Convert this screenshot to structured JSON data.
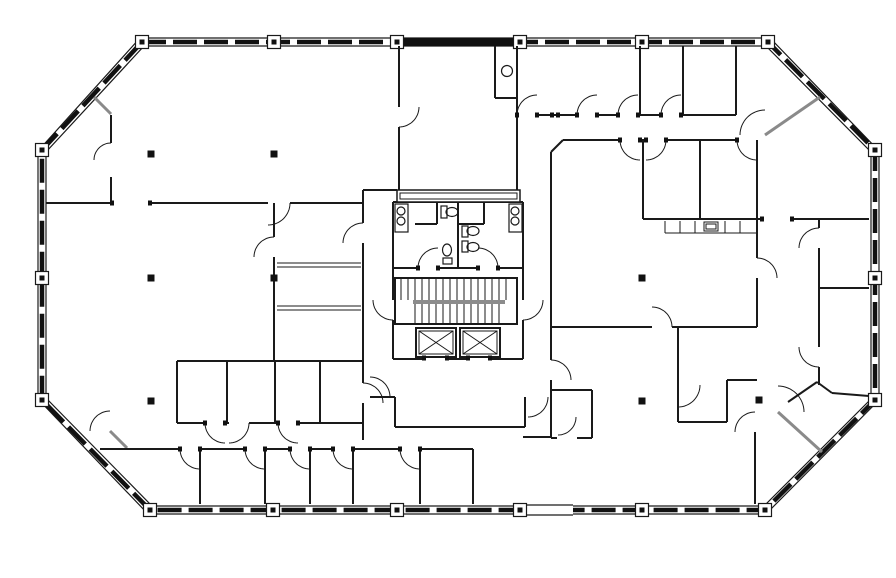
{
  "drawing": {
    "kind": "architectural-floor-plan",
    "background": "#ffffff",
    "wall_color": "#1a1a1a",
    "glazing_color": "#111111",
    "partition_gray": "#8a8a8a",
    "column_fill": "#111111"
  },
  "summary": {
    "elevators": 2,
    "stair_flights": 2,
    "restrooms": 2,
    "toilets": 4,
    "lavatory_sinks": 4,
    "counter_sinks": 2,
    "interior_columns": 8,
    "perimeter_columns": 18,
    "door_swings": 38
  },
  "floor_plan": {
    "canvas": {
      "w": 896,
      "h": 578
    },
    "shell": {
      "outer": [
        [
          140,
          38
        ],
        [
          770,
          38
        ],
        [
          879,
          151
        ],
        [
          879,
          400
        ],
        [
          766,
          514
        ],
        [
          148,
          514
        ],
        [
          38,
          399
        ],
        [
          38,
          151
        ]
      ],
      "inner": [
        [
          144,
          46
        ],
        [
          766,
          46
        ],
        [
          871,
          152
        ],
        [
          871,
          399
        ],
        [
          764,
          506
        ],
        [
          152,
          506
        ],
        [
          46,
          398
        ],
        [
          46,
          152
        ]
      ],
      "center": [
        [
          142,
          42
        ],
        [
          768,
          42
        ],
        [
          875,
          150
        ],
        [
          875,
          400
        ],
        [
          765,
          510
        ],
        [
          150,
          510
        ],
        [
          42,
          400
        ],
        [
          42,
          150
        ]
      ],
      "solid_band_rect": [
        399,
        38,
        118,
        8
      ],
      "band_gap_rect": [
        523,
        504,
        50,
        12
      ],
      "mullion_columns": [
        [
          142,
          42
        ],
        [
          274,
          42
        ],
        [
          397,
          42
        ],
        [
          520,
          42
        ],
        [
          642,
          42
        ],
        [
          768,
          42
        ],
        [
          875,
          150
        ],
        [
          875,
          278
        ],
        [
          875,
          400
        ],
        [
          765,
          510
        ],
        [
          642,
          510
        ],
        [
          520,
          510
        ],
        [
          397,
          510
        ],
        [
          273,
          510
        ],
        [
          150,
          510
        ],
        [
          42,
          400
        ],
        [
          42,
          278
        ],
        [
          42,
          150
        ]
      ]
    },
    "walls": [
      [
        46,
        203,
        111,
        203
      ],
      [
        150,
        203,
        268,
        203
      ],
      [
        290,
        203,
        363,
        203
      ],
      [
        111,
        115,
        111,
        143
      ],
      [
        111,
        177,
        111,
        203
      ],
      [
        363,
        190,
        363,
        223
      ],
      [
        363,
        243,
        363,
        383
      ],
      [
        363,
        403,
        363,
        440
      ],
      [
        363,
        190,
        397,
        190
      ],
      [
        274,
        203,
        274,
        237
      ],
      [
        274,
        257,
        274,
        361
      ],
      [
        177,
        361,
        177,
        423
      ],
      [
        177,
        361,
        363,
        361
      ],
      [
        227,
        361,
        227,
        423
      ],
      [
        275,
        361,
        275,
        423
      ],
      [
        320,
        361,
        320,
        423
      ],
      [
        177,
        423,
        205,
        423
      ],
      [
        225,
        423,
        229,
        423
      ],
      [
        249,
        423,
        278,
        423
      ],
      [
        298,
        423,
        363,
        423
      ],
      [
        100,
        449,
        180,
        449
      ],
      [
        200,
        449,
        245,
        449
      ],
      [
        265,
        449,
        290,
        449
      ],
      [
        310,
        449,
        333,
        449
      ],
      [
        353,
        449,
        400,
        449
      ],
      [
        420,
        449,
        473,
        449
      ],
      [
        200,
        449,
        200,
        504
      ],
      [
        265,
        449,
        265,
        504
      ],
      [
        310,
        449,
        310,
        504
      ],
      [
        353,
        449,
        353,
        504
      ],
      [
        420,
        449,
        420,
        504
      ],
      [
        473,
        449,
        473,
        504
      ],
      [
        399,
        46,
        399,
        107
      ],
      [
        399,
        127,
        399,
        190
      ],
      [
        517,
        46,
        517,
        190
      ],
      [
        495,
        46,
        495,
        98
      ],
      [
        495,
        98,
        517,
        98
      ],
      [
        537,
        115,
        577,
        115
      ],
      [
        597,
        115,
        618,
        115
      ],
      [
        638,
        115,
        661,
        115
      ],
      [
        681,
        115,
        736,
        115
      ],
      [
        640,
        46,
        640,
        115
      ],
      [
        683,
        46,
        683,
        115
      ],
      [
        736,
        46,
        736,
        115
      ],
      [
        563,
        140,
        620,
        140
      ],
      [
        640,
        140,
        646,
        140
      ],
      [
        666,
        140,
        737,
        140
      ],
      [
        551,
        152,
        563,
        140
      ],
      [
        551,
        152,
        551,
        360
      ],
      [
        551,
        380,
        551,
        437
      ],
      [
        643,
        140,
        643,
        219
      ],
      [
        700,
        140,
        700,
        219
      ],
      [
        757,
        140,
        757,
        219
      ],
      [
        643,
        219,
        762,
        219
      ],
      [
        792,
        219,
        869,
        219
      ],
      [
        551,
        327,
        652,
        327
      ],
      [
        672,
        327,
        757,
        327
      ],
      [
        757,
        219,
        757,
        258
      ],
      [
        757,
        278,
        757,
        327
      ],
      [
        819,
        219,
        819,
        228
      ],
      [
        819,
        248,
        819,
        347
      ],
      [
        819,
        367,
        819,
        385
      ],
      [
        819,
        288,
        869,
        288
      ],
      [
        788,
        402,
        817,
        382
      ],
      [
        817,
        382,
        832,
        393
      ],
      [
        832,
        393,
        869,
        396
      ],
      [
        755,
        432,
        755,
        504
      ],
      [
        551,
        390,
        592,
        390
      ],
      [
        592,
        390,
        592,
        438
      ],
      [
        551,
        438,
        557,
        438
      ],
      [
        577,
        438,
        592,
        438
      ],
      [
        523,
        437,
        551,
        437
      ],
      [
        395,
        397,
        395,
        427
      ],
      [
        395,
        427,
        525,
        427
      ],
      [
        525,
        397,
        525,
        427
      ],
      [
        370,
        397,
        395,
        397
      ],
      [
        678,
        327,
        678,
        422
      ],
      [
        678,
        422,
        727,
        422
      ],
      [
        727,
        380,
        727,
        422
      ],
      [
        727,
        380,
        757,
        380
      ],
      [
        393,
        202,
        393,
        268
      ],
      [
        523,
        202,
        523,
        268
      ],
      [
        393,
        202,
        523,
        202
      ],
      [
        393,
        268,
        418,
        268
      ],
      [
        438,
        268,
        478,
        268
      ],
      [
        498,
        268,
        523,
        268
      ],
      [
        458,
        202,
        458,
        268
      ],
      [
        437,
        202,
        437,
        224
      ],
      [
        415,
        224,
        437,
        224
      ],
      [
        484,
        202,
        484,
        224
      ],
      [
        458,
        224,
        484,
        224
      ],
      [
        393,
        268,
        393,
        300
      ],
      [
        393,
        320,
        393,
        359
      ],
      [
        523,
        268,
        523,
        300
      ],
      [
        523,
        320,
        523,
        359
      ],
      [
        393,
        359,
        424,
        359
      ],
      [
        448,
        359,
        467,
        359
      ],
      [
        491,
        359,
        523,
        359
      ]
    ],
    "thin_walls": [
      [
        277,
        263,
        361,
        263
      ],
      [
        277,
        267,
        361,
        267
      ],
      [
        277,
        306,
        361,
        306
      ],
      [
        277,
        310,
        361,
        310
      ],
      [
        665,
        233,
        757,
        233
      ],
      [
        665,
        221,
        665,
        233
      ],
      [
        680,
        221,
        680,
        233
      ],
      [
        695,
        221,
        695,
        233
      ],
      [
        725,
        221,
        725,
        233
      ],
      [
        740,
        221,
        740,
        233
      ]
    ],
    "gray_partitions": [
      [
        94,
        97,
        111,
        114
      ],
      [
        110,
        431,
        127,
        448
      ],
      [
        765,
        135,
        820,
        97
      ],
      [
        778,
        412,
        822,
        452
      ]
    ],
    "door_arcs": [
      [
        111,
        160,
        17,
        180,
        270
      ],
      [
        268,
        203,
        22,
        0,
        90
      ],
      [
        363,
        243,
        20,
        180,
        270
      ],
      [
        363,
        403,
        20,
        270,
        360
      ],
      [
        399,
        107,
        20,
        0,
        90
      ],
      [
        537,
        115,
        20,
        180,
        270
      ],
      [
        597,
        115,
        20,
        180,
        270
      ],
      [
        638,
        115,
        20,
        180,
        270
      ],
      [
        681,
        115,
        20,
        180,
        270
      ],
      [
        765,
        135,
        25,
        180,
        270
      ],
      [
        640,
        140,
        20,
        90,
        180
      ],
      [
        646,
        140,
        20,
        0,
        90
      ],
      [
        757,
        140,
        20,
        90,
        180
      ],
      [
        652,
        327,
        20,
        270,
        360
      ],
      [
        757,
        278,
        20,
        270,
        360
      ],
      [
        819,
        248,
        20,
        180,
        270
      ],
      [
        819,
        347,
        20,
        90,
        180
      ],
      [
        438,
        268,
        20,
        180,
        270
      ],
      [
        478,
        268,
        20,
        270,
        360
      ],
      [
        393,
        300,
        20,
        90,
        180
      ],
      [
        523,
        300,
        20,
        0,
        90
      ],
      [
        370,
        397,
        20,
        270,
        360
      ],
      [
        528,
        397,
        20,
        0,
        90
      ],
      [
        551,
        380,
        20,
        270,
        360
      ],
      [
        558,
        417,
        18,
        0,
        90
      ],
      [
        678,
        385,
        22,
        0,
        90
      ],
      [
        778,
        412,
        26,
        270,
        360
      ],
      [
        755,
        432,
        20,
        180,
        270
      ],
      [
        110,
        431,
        20,
        180,
        270
      ],
      [
        200,
        449,
        20,
        90,
        180
      ],
      [
        265,
        449,
        20,
        90,
        180
      ],
      [
        310,
        449,
        20,
        90,
        180
      ],
      [
        353,
        449,
        20,
        90,
        180
      ],
      [
        420,
        449,
        20,
        90,
        180
      ],
      [
        225,
        423,
        20,
        90,
        180
      ],
      [
        229,
        423,
        20,
        0,
        90
      ],
      [
        298,
        423,
        20,
        90,
        180
      ],
      [
        274,
        257,
        20,
        180,
        270
      ]
    ],
    "jambs": [
      [
        418,
        268
      ],
      [
        438,
        268
      ],
      [
        478,
        268
      ],
      [
        498,
        268
      ],
      [
        620,
        140
      ],
      [
        640,
        140
      ],
      [
        646,
        140
      ],
      [
        666,
        140
      ],
      [
        737,
        140
      ],
      [
        517,
        115
      ],
      [
        537,
        115
      ],
      [
        577,
        115
      ],
      [
        597,
        115
      ],
      [
        618,
        115
      ],
      [
        638,
        115
      ],
      [
        661,
        115
      ],
      [
        681,
        115
      ],
      [
        205,
        423
      ],
      [
        225,
        423
      ],
      [
        278,
        423
      ],
      [
        298,
        423
      ],
      [
        180,
        449
      ],
      [
        200,
        449
      ],
      [
        245,
        449
      ],
      [
        265,
        449
      ],
      [
        290,
        449
      ],
      [
        310,
        449
      ],
      [
        333,
        449
      ],
      [
        353,
        449
      ],
      [
        400,
        449
      ],
      [
        420,
        449
      ],
      [
        424,
        358
      ],
      [
        447,
        358
      ],
      [
        468,
        358
      ],
      [
        490,
        358
      ],
      [
        552,
        115
      ],
      [
        558,
        115
      ],
      [
        762,
        219
      ],
      [
        792,
        219
      ],
      [
        112,
        203
      ],
      [
        150,
        203
      ]
    ],
    "interior_columns": [
      [
        151,
        154
      ],
      [
        274,
        154
      ],
      [
        151,
        278
      ],
      [
        274,
        278
      ],
      [
        151,
        401
      ],
      [
        642,
        278
      ],
      [
        642,
        401
      ],
      [
        759,
        400
      ]
    ],
    "stair": {
      "box": [
        395,
        278,
        122,
        46
      ],
      "upper_treads": {
        "x0": 401,
        "x1": 511,
        "step": 7,
        "y0": 279,
        "y1": 300
      },
      "rails": [
        [
          413,
          301,
          505,
          301
        ],
        [
          413,
          303,
          505,
          303
        ]
      ],
      "lower_treads": {
        "x0": 415,
        "x1": 503,
        "step": 7,
        "y0": 304,
        "y1": 323
      }
    },
    "elevators": [
      {
        "box": [
          416,
          328,
          40,
          29
        ]
      },
      {
        "box": [
          460,
          328,
          40,
          29
        ]
      }
    ],
    "shaft_bar": {
      "outer": [
        397,
        190,
        123,
        12
      ],
      "inner": [
        400,
        193,
        117,
        6
      ]
    },
    "fixtures": {
      "sink_consoles": [
        [
          395,
          204,
          13,
          28
        ],
        [
          509,
          204,
          13,
          28
        ]
      ],
      "sink_circles": [
        [
          401,
          211,
          4
        ],
        [
          401,
          221,
          4
        ],
        [
          515,
          211,
          4
        ],
        [
          515,
          221,
          4
        ]
      ],
      "kitchen_sink_circle": [
        507,
        71,
        5.5
      ],
      "counter_sink_rects": [
        [
          704,
          222,
          14,
          9
        ],
        [
          706,
          224,
          10,
          5
        ]
      ],
      "toilet_tanks": [
        [
          441,
          206,
          6,
          12
        ],
        [
          443,
          258,
          9,
          6
        ],
        [
          462,
          226,
          6,
          11
        ],
        [
          462,
          241,
          6,
          11
        ]
      ],
      "toilet_bowls": [
        [
          452,
          212,
          6,
          4.5
        ],
        [
          447,
          250,
          4.5,
          6
        ],
        [
          473,
          231,
          6,
          4.5
        ],
        [
          473,
          247,
          6,
          4.5
        ]
      ]
    }
  }
}
